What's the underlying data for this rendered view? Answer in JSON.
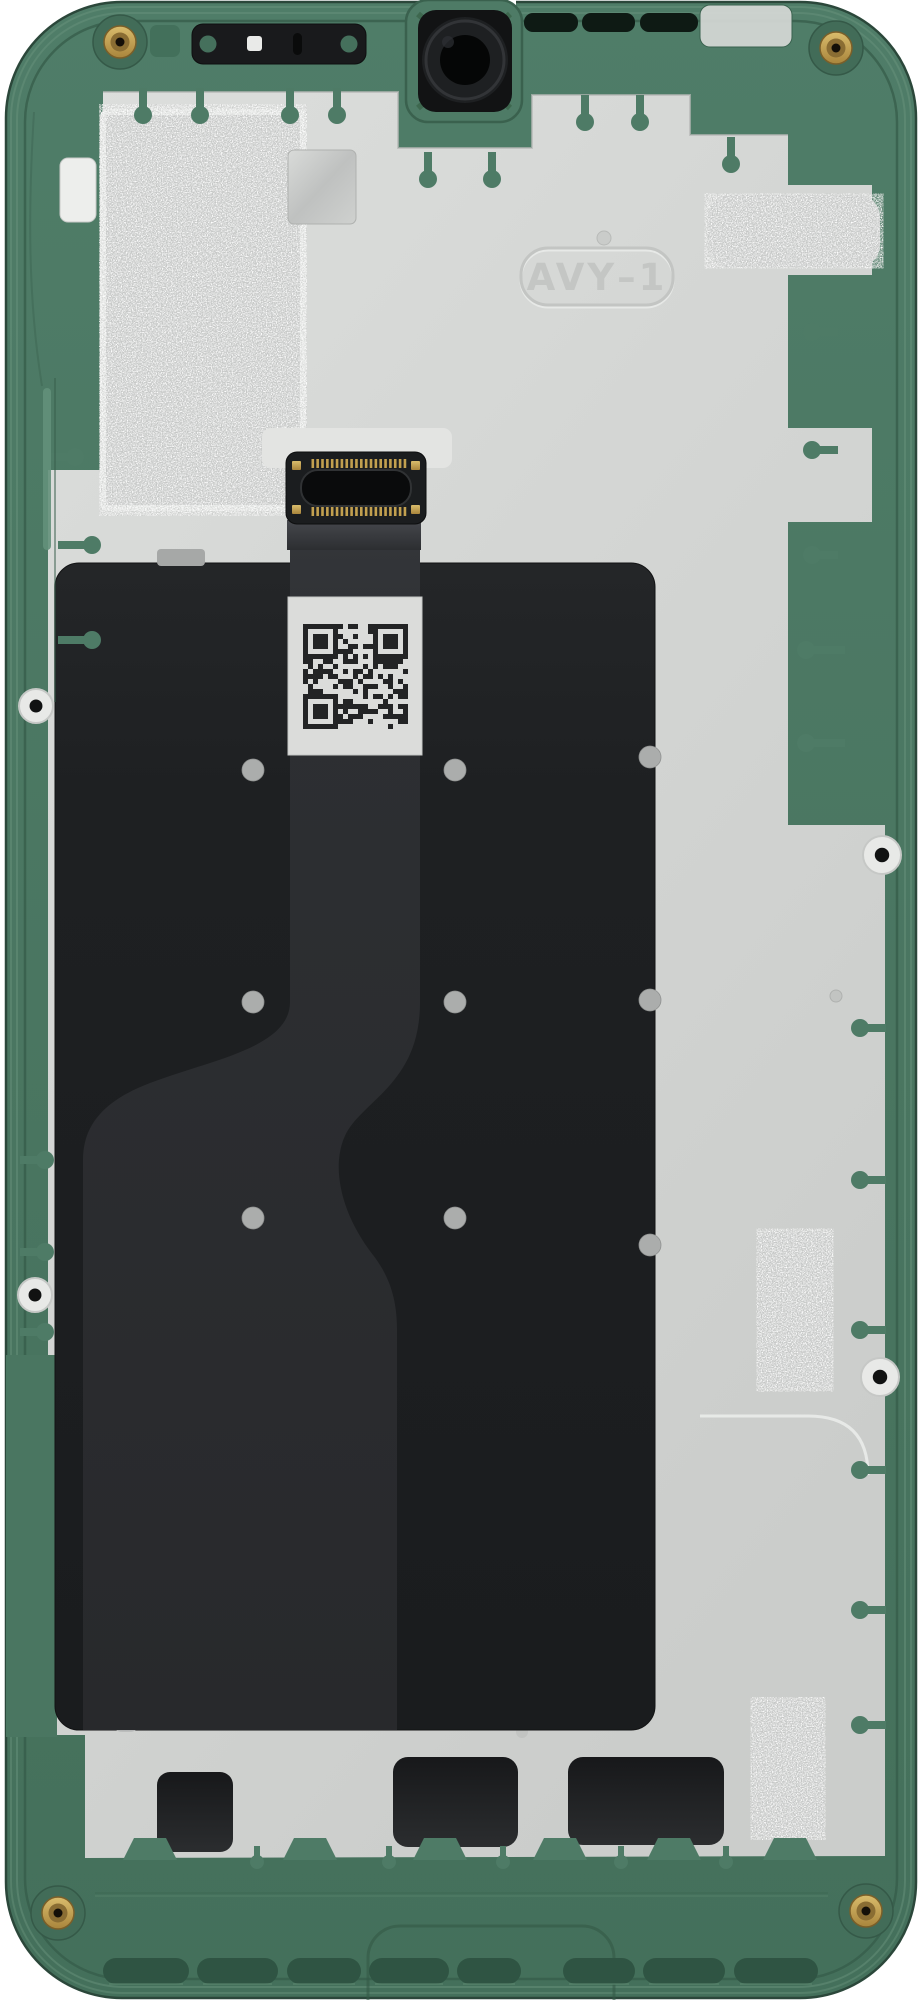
{
  "scene": {
    "description": "Internal view of a disassembled smartphone mid-frame with graphite shield plate, display flex cable and QR service sticker",
    "stamp_label": "AVY–1"
  },
  "colors": {
    "frame_green": "#4E7B66",
    "frame_green_dark": "#3A614E",
    "frame_green_deep": "#2B473A",
    "frame_green_light": "#68927C",
    "recess_green": "#2F5443",
    "plate_gray": "#D6D8D6",
    "plate_gray_dark": "#C7C9C7",
    "plate_white": "#E9EBE9",
    "foil_gray": "#C7C9C8",
    "panel_black": "#1C1E20",
    "flex_gray": "#2C2E31",
    "connector_black": "#1B1D1F",
    "slot_black": "#0A0B0C",
    "gold": "#C2A04F",
    "brass_dark": "#8A6D33",
    "sticker_white": "#DBDCDA",
    "qr_dark": "#232425",
    "dot_gray": "#ABADAC",
    "screw_white": "#E8E9E7"
  },
  "counts": {
    "connector_pins_per_row": 20,
    "qr_modules": 21,
    "brass_screw_inserts": 4,
    "white_screw_bosses": 4,
    "panel_dots": 9,
    "bottom_vent_slots": 8,
    "bottom_port_cutouts": 3
  }
}
